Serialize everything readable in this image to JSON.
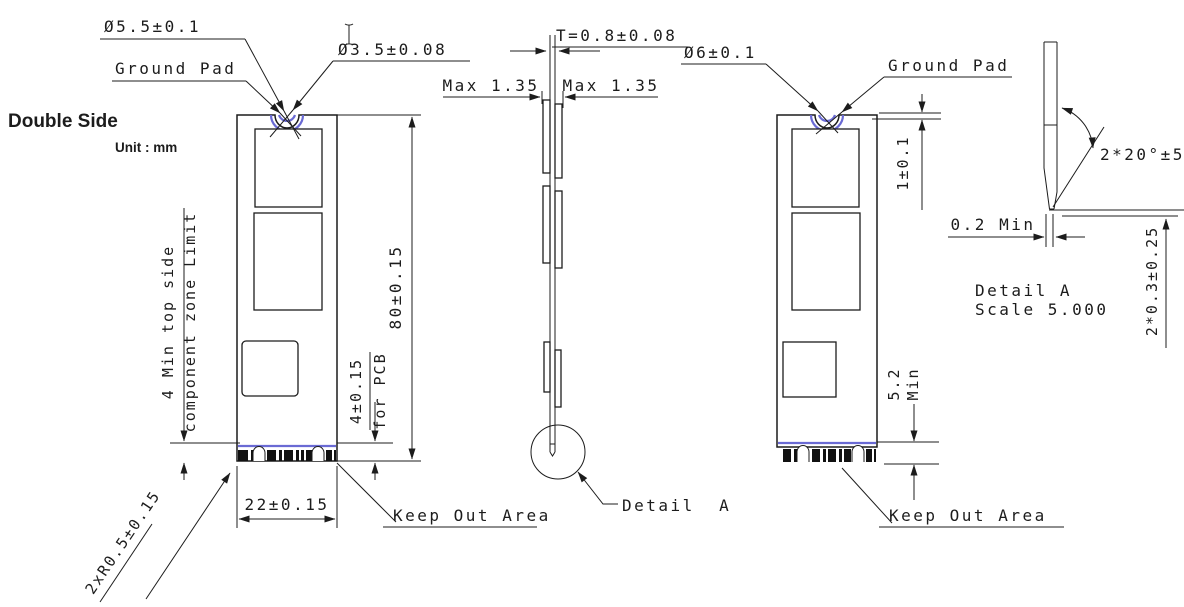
{
  "header": {
    "title": "Double Side",
    "unit": "Unit : mm"
  },
  "colors": {
    "line": "#1c1c1c",
    "accent_blue": "#6a6ad4",
    "pad_black": "#111111",
    "background": "#ffffff"
  },
  "front_view": {
    "labels": {
      "pad_diameter": "Ø5.5±0.1",
      "ground_pad": "Ground Pad",
      "hole_diameter": "Ø3.5±0.08",
      "board_length": "80±0.15",
      "component_zone_line1": "4 Min top side",
      "component_zone_line2": "component zone Limit",
      "connector_dim_line1": "4±0.15",
      "connector_dim_line2": "for PCB",
      "board_width": "22±0.15",
      "corner_radius": "2xR0.5±0.15",
      "keep_out": "Keep Out Area"
    }
  },
  "side_view": {
    "labels": {
      "thickness": "T=0.8±0.08",
      "max_component_left": "Max 1.35",
      "max_component_right": "Max 1.35",
      "detail_callout": "Detail  A"
    }
  },
  "back_view": {
    "labels": {
      "pad_diameter": "Ø6±0.1",
      "ground_pad": "Ground Pad",
      "pad_offset": "1±0.1",
      "connector_min_line1": "5.2",
      "connector_min_line2": "Min",
      "keep_out": "Keep Out Area"
    }
  },
  "detail_a": {
    "labels": {
      "tip_flat": "0.2 Min",
      "chamfer_angle": "2*20°±5°",
      "title_line1": "Detail A",
      "title_line2": "Scale 5.000",
      "chamfer_depth": "2*0.3±0.25"
    }
  }
}
